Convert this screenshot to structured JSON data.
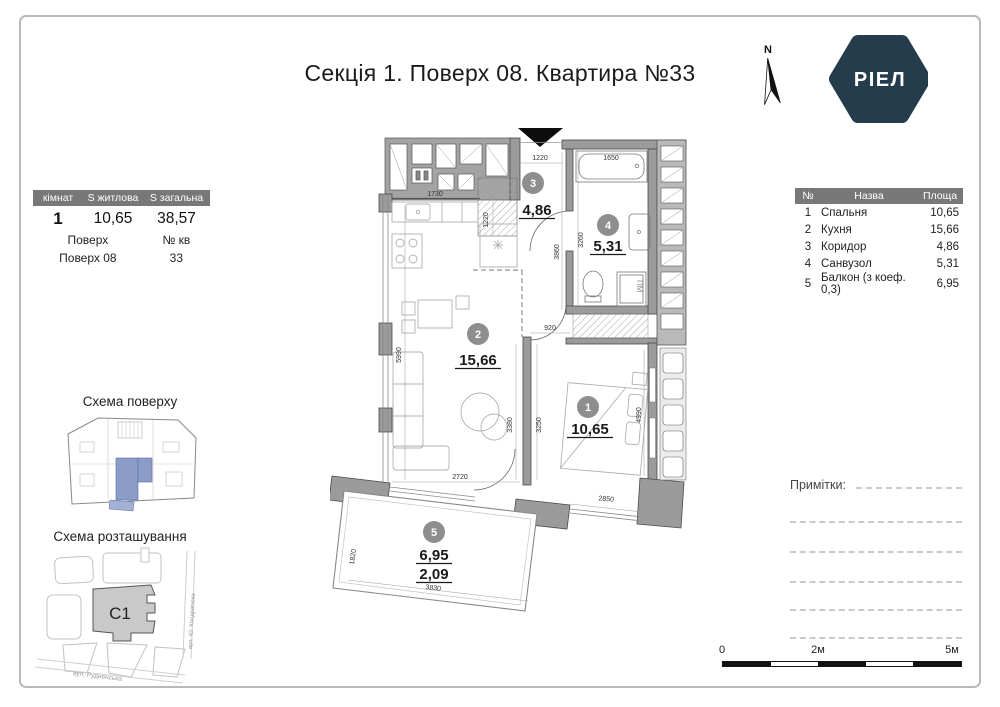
{
  "title": "Секція 1. Поверх 08. Квартира №33",
  "logo": {
    "text": "РІЕЛ"
  },
  "north_label": "N",
  "unit_table": {
    "headers": [
      "кімнат",
      "S житлова",
      "S загальна"
    ],
    "rooms_count": "1",
    "s_living": "10,65",
    "s_total": "38,57",
    "floor_label": "Поверх",
    "apt_label": "№ кв",
    "floor_value": "Поверх 08",
    "apt_value": "33"
  },
  "legend": {
    "headers": [
      "№",
      "Назва",
      "Площа"
    ],
    "rows": [
      {
        "num": "1",
        "name": "Спальня",
        "area": "10,65"
      },
      {
        "num": "2",
        "name": "Кухня",
        "area": "15,66"
      },
      {
        "num": "3",
        "name": "Коридор",
        "area": "4,86"
      },
      {
        "num": "4",
        "name": "Санвузол",
        "area": "5,31"
      },
      {
        "num": "5",
        "name": "Балкон (з коеф. 0,3)",
        "area": "6,95"
      }
    ]
  },
  "plan": {
    "rooms": [
      {
        "num": "1",
        "area": "10,65"
      },
      {
        "num": "2",
        "area": "15,66"
      },
      {
        "num": "3",
        "area": "4,86"
      },
      {
        "num": "4",
        "area": "5,31"
      },
      {
        "num": "5",
        "area": "6,95",
        "area2": "2,09"
      }
    ],
    "washer_label": "ПМ",
    "dimensions": {
      "top_1220": "1220",
      "tub_1650": "1650",
      "kitchen_1730": "1730",
      "vert_1220": "1220",
      "hall_3860": "3860",
      "bath_3260": "3260",
      "door_920": "920",
      "left_5990": "5990",
      "kitchen_3380": "3380",
      "bedroom_3250": "3250",
      "bedroom_4990": "4990",
      "kitchen_2720": "2720",
      "bedroom_2850": "2850",
      "balcony_1820": "1820",
      "balcony_3830": "3830"
    }
  },
  "schemes": {
    "floor": {
      "title": "Схема поверху"
    },
    "location": {
      "title": "Схема розташування",
      "building": "С1",
      "street_right": "вул. Ю. Кондратюка",
      "street_bottom": "вул. Рудненська"
    }
  },
  "notes_label": "Примітки:",
  "scale": {
    "labels": [
      "0",
      "2м",
      "5м"
    ]
  },
  "colors": {
    "table_header": "#787878",
    "logo_bg": "#253c4c",
    "wall_gray": "#9b9b9b",
    "room_badge": "#8e8e8e",
    "scheme_highlight": "#8b9cc8"
  }
}
